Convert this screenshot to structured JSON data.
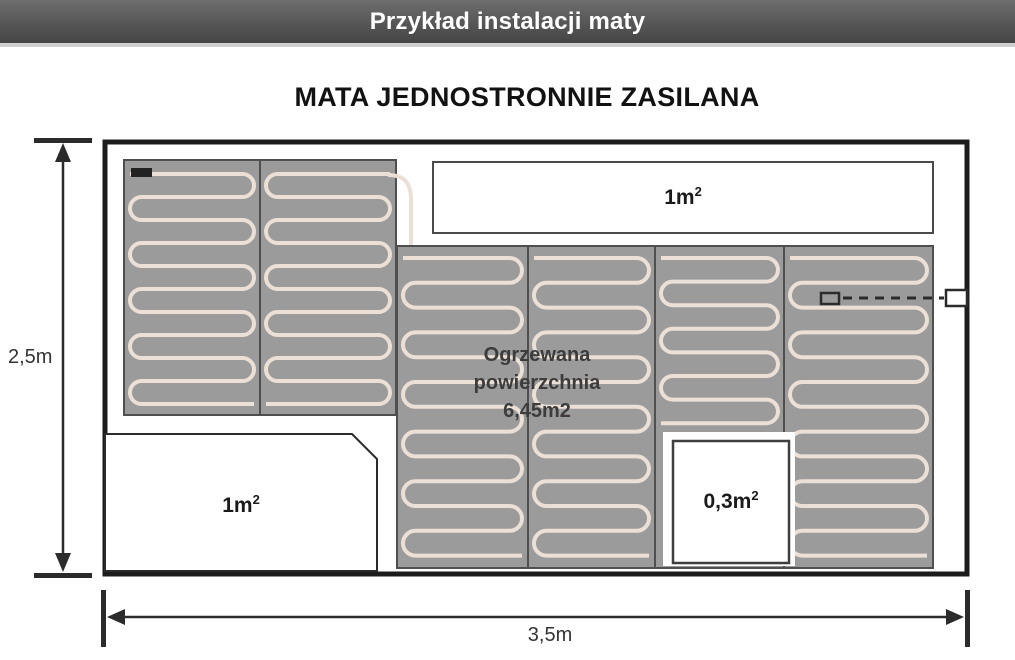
{
  "header": {
    "title": "Przykład instalacji maty"
  },
  "diagram": {
    "title": "MATA JEDNOSTRONNIE ZASILANA",
    "heated_area": {
      "line1": "Ogrzewana",
      "line2": "powierzchnia",
      "line3": "6,45m2"
    },
    "cutout_top": {
      "value": "1m",
      "sup": "2"
    },
    "cutout_bottom_left": {
      "value": "1m",
      "sup": "2"
    },
    "cutout_bottom_middle": {
      "value": "0,3m",
      "sup": "2"
    },
    "dim_height": "2,5m",
    "dim_width": "3,5m"
  },
  "colors": {
    "mat_fill": "#9b9b9b",
    "mat_border": "#4f4f4f",
    "cable": "#ece0d6",
    "line_dark": "#2b2b2b",
    "room_border": "#1c1c1c"
  }
}
